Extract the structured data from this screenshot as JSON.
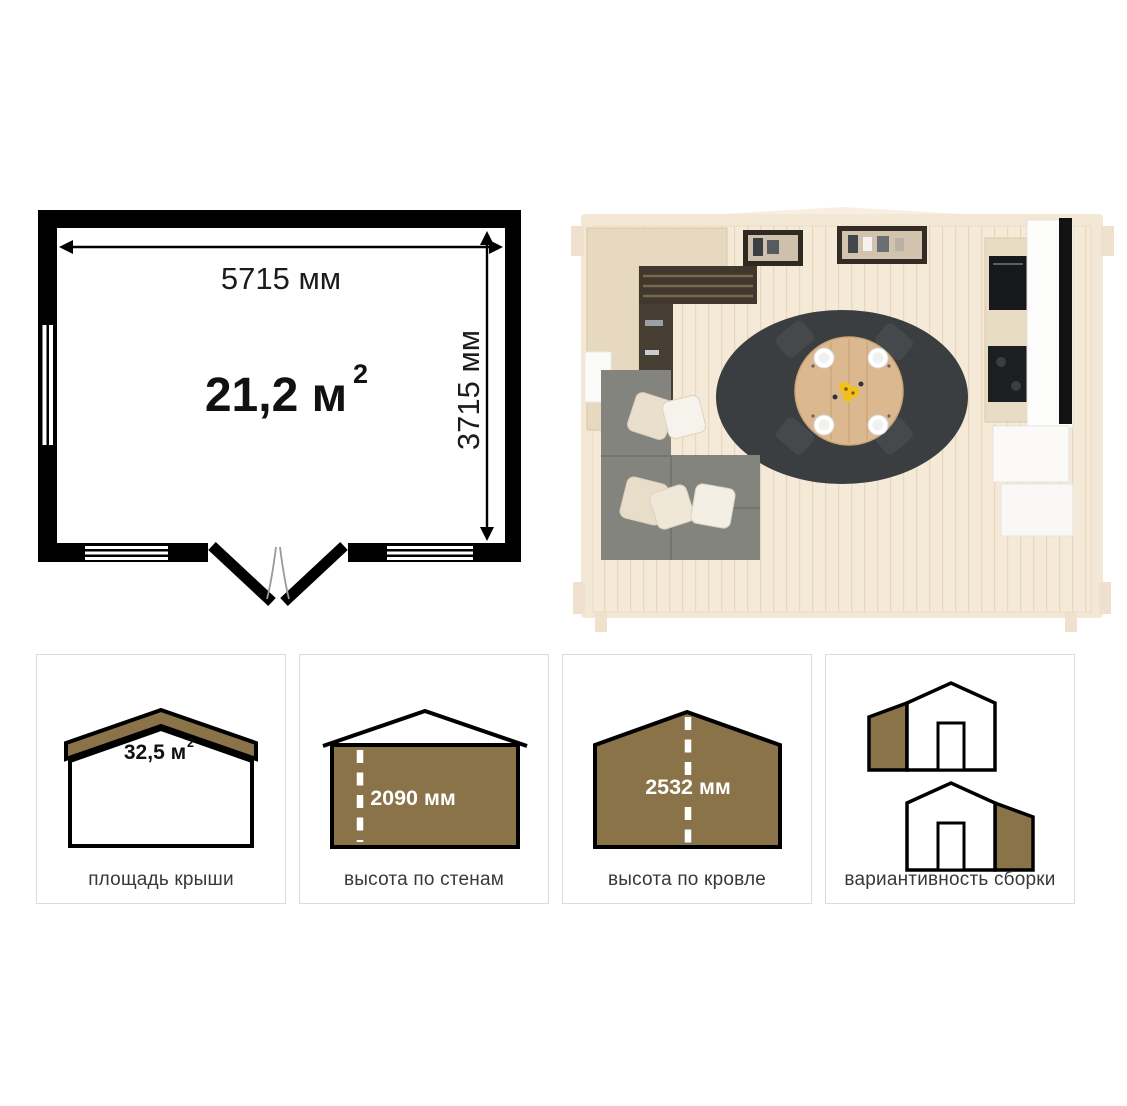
{
  "colors": {
    "accent_brown": "#8a7348",
    "plan_black": "#000000",
    "rug_charcoal": "#3b3e40",
    "sofa_gray": "#84847f",
    "table_wood": "#dbb890",
    "flower_yellow": "#f0c11c"
  },
  "floor_plan": {
    "width_label": "5715 мм",
    "depth_label": "3715 мм",
    "area_value": "21,2 м",
    "area_sup": "2"
  },
  "spec_cards": {
    "roof_area": {
      "label": "площадь крыши",
      "value": "32,5 м",
      "value_sup": "2"
    },
    "wall_height": {
      "label": "высота по стенам",
      "value": "2090 мм"
    },
    "ridge_height": {
      "label": "высота по кровле",
      "value": "2532 мм"
    },
    "assembly": {
      "label": "вариантивность сборки"
    }
  }
}
